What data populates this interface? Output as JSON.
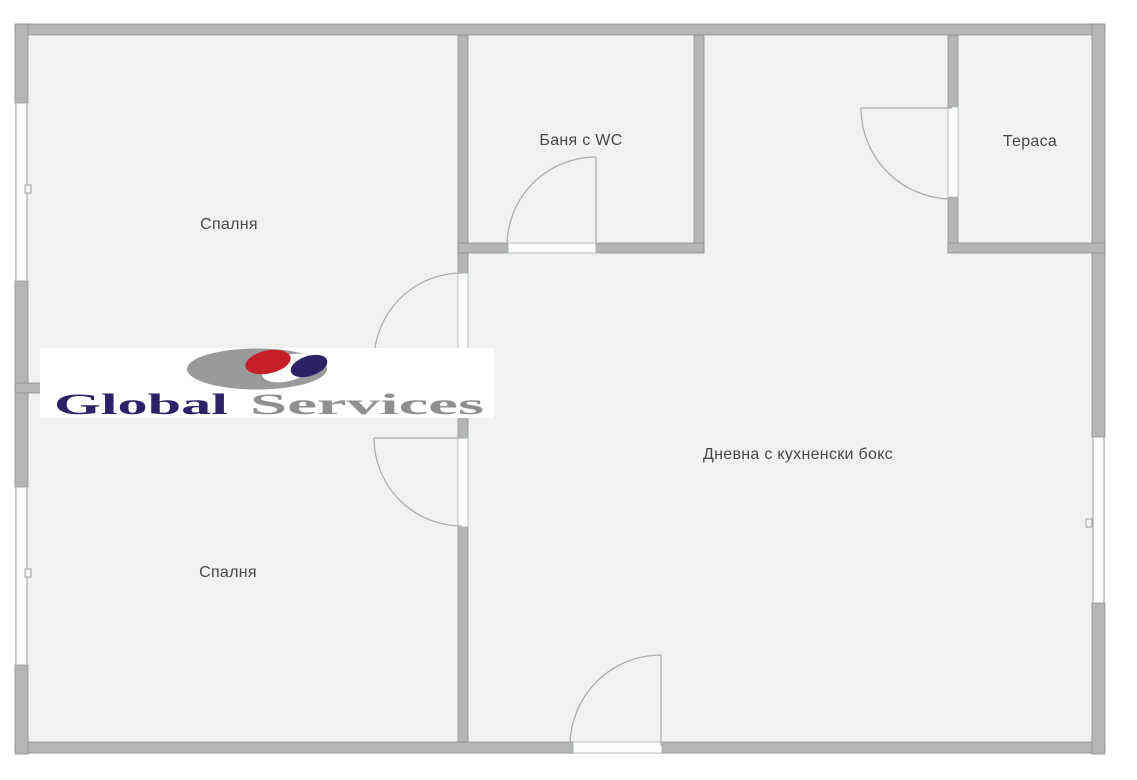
{
  "plan": {
    "type": "apartment-floor-plan",
    "rooms": [
      {
        "id": "bedroom-top",
        "label": "Спалня"
      },
      {
        "id": "bathroom",
        "label": "Баня с WC"
      },
      {
        "id": "terrace",
        "label": "Тераса"
      },
      {
        "id": "living-room",
        "label": "Дневна с кухненски бокс"
      },
      {
        "id": "bedroom-bottom",
        "label": "Спалня"
      }
    ],
    "colors": {
      "floor": "#f0f1f1",
      "wall": "#b3b5b6",
      "wall_edge": "#8f9192",
      "door_arc": "#abadaf",
      "label_text": "#474747",
      "background": "#ffffff"
    },
    "counts": {
      "doors": 5,
      "windows": 3
    }
  },
  "watermark": {
    "word1": "Global",
    "word2": "Services",
    "word1_color": "#2d2266",
    "word2_color": "#8f8f8f",
    "background": "#ffffff",
    "globe_gray": "#989a9b",
    "globe_red": "#c8202b",
    "globe_navy": "#2d2266"
  }
}
